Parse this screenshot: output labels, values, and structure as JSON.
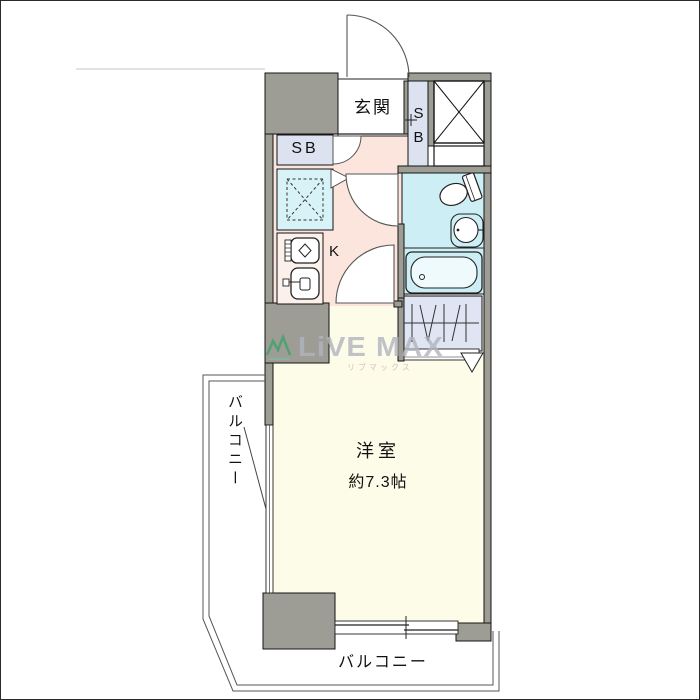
{
  "page_type": "real-estate-floorplan",
  "rooms": {
    "entrance_label": "玄関",
    "shoebox_strip_letters": [
      "S",
      "B"
    ],
    "shoebox_left_label": "SB",
    "kitchen_label": "K",
    "main_room_label": "洋室",
    "main_room_size": "約7.3帖",
    "balcony_left_label": "バルコニー",
    "balcony_bottom_label": "バルコニー"
  },
  "watermark": {
    "brand": "LiVE MAX",
    "brand_kana": "リブマックス"
  },
  "colors": {
    "wall": "#9d9d96",
    "corridor_kitchen": "#fbe5dd",
    "bathroom": "#cdeef4",
    "laundry_space": "#d8f3f7",
    "shoebox": "#dde2f0",
    "closet": "#e0e5f4",
    "main_room": "#fdfce8",
    "watermark_gray": "#b2b4bf",
    "watermark_green": "#3fa46b",
    "watermark_pink": "#dca8bc"
  },
  "icons": [
    "entrance-door-arc",
    "shoebox-door-arc",
    "bathroom-door-arc",
    "room-door-arc",
    "fold-door-triangle",
    "pipe-space-x-box",
    "washer-space-dashed-box",
    "stove-icon",
    "sink-icon",
    "toilet-icon",
    "washbasin-icon",
    "bathtub-icon",
    "closet-hanger-symbol",
    "closet-door-triangle",
    "sliding-window",
    "casement-window-line",
    "wall-cross-mark",
    "balcony-railing"
  ]
}
